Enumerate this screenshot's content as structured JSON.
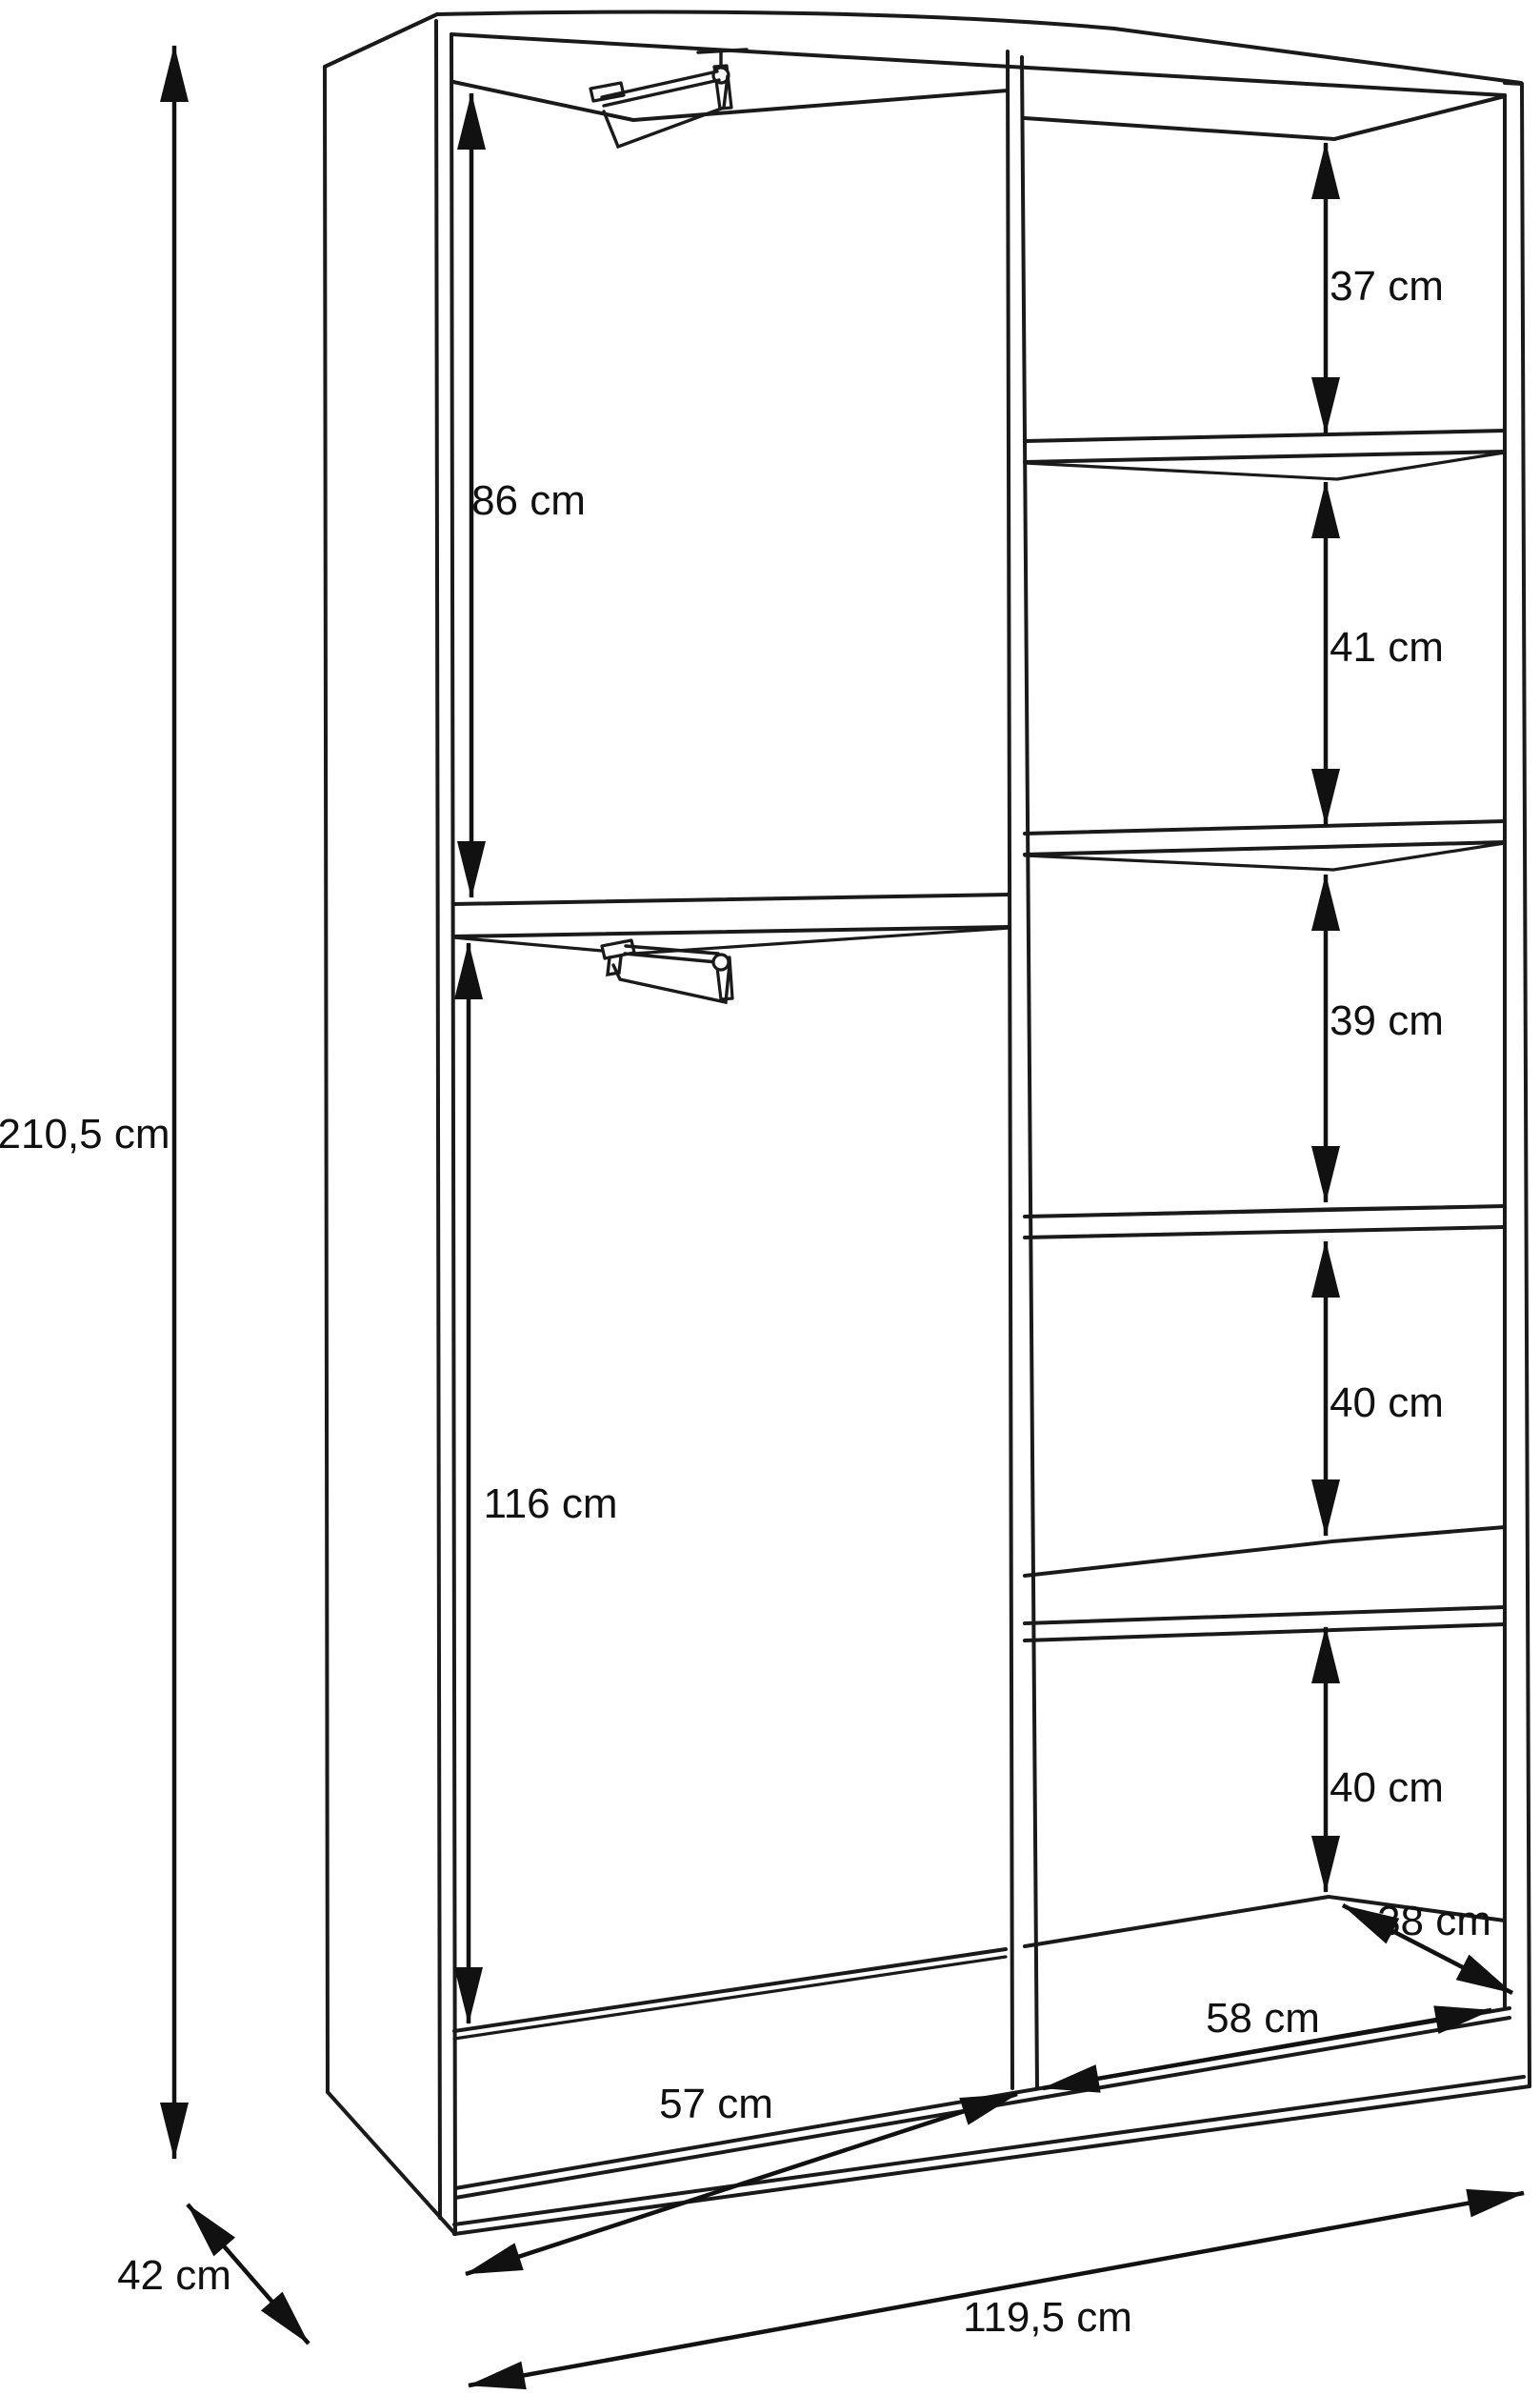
{
  "diagram": {
    "type": "furniture-technical-drawing",
    "subject": "wardrobe interior dimension diagram",
    "background_color": "#ffffff",
    "line_color": "#1a1a1a",
    "unit": "cm",
    "labels": {
      "overall_height": "210,5 cm",
      "overall_width": "119,5 cm",
      "overall_depth": "42 cm",
      "interior_depth": "38 cm",
      "left_section_width": "57 cm",
      "right_section_width": "58 cm",
      "left_upper_compartment_height": "86 cm",
      "left_lower_compartment_height": "116 cm",
      "right_compartment_heights": [
        "37 cm",
        "41 cm",
        "39 cm",
        "40 cm",
        "40 cm"
      ]
    },
    "features": {
      "left_section": "two hanging areas with pull-down clothes rails and one fixed shelf",
      "right_section": "five shelf compartments",
      "shelf_count_right": 5,
      "pull_down_rail_count": 2
    }
  }
}
